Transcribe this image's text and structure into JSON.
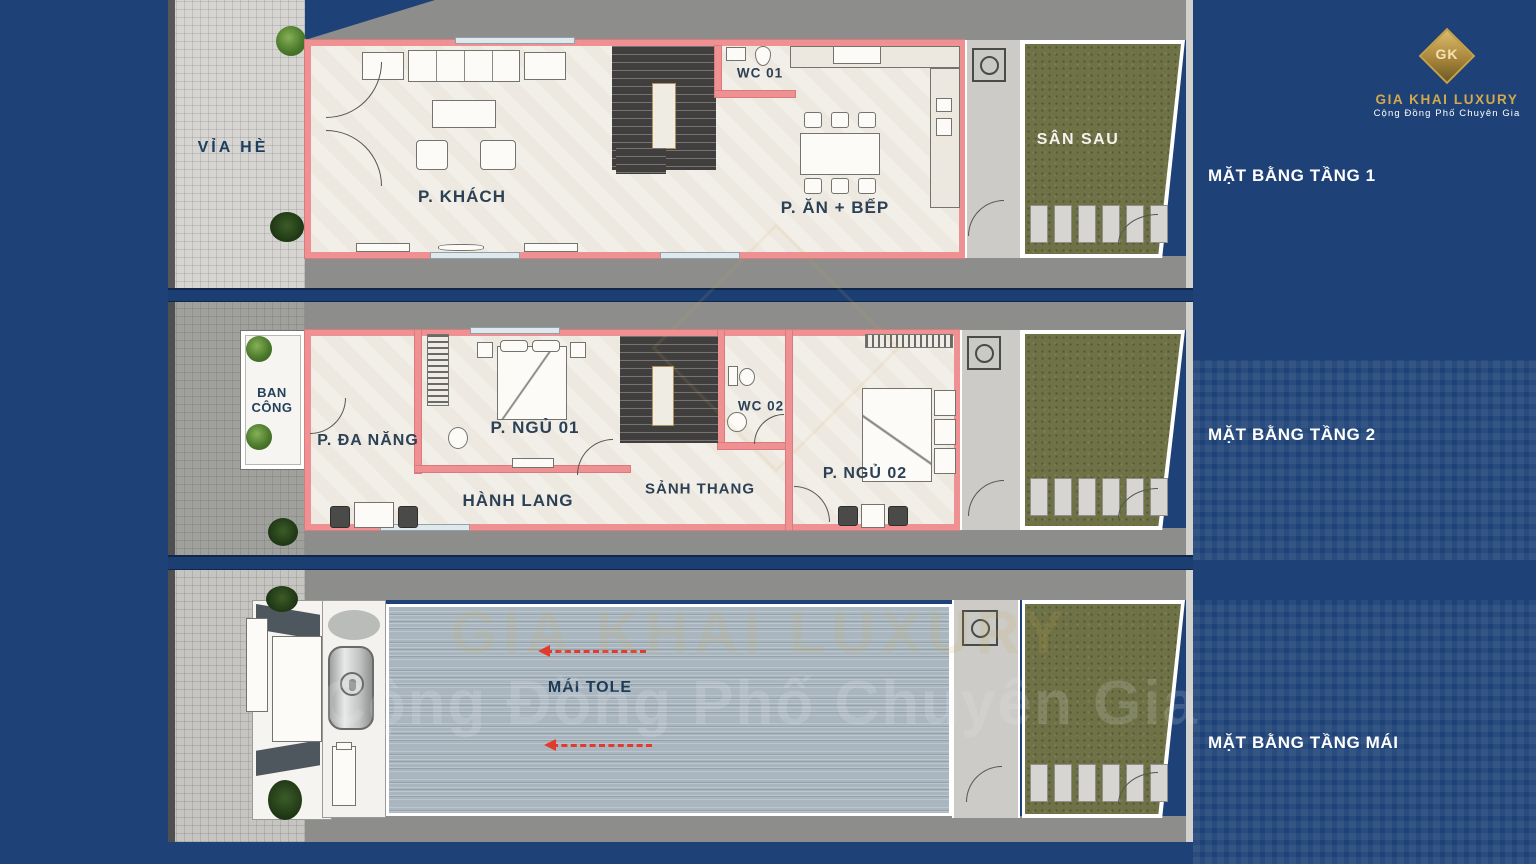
{
  "poster": {
    "background": "#1e4277"
  },
  "logo": {
    "monogram": "GK",
    "brand": "GIA KHAI LUXURY",
    "tagline": "Cộng Đồng Phố Chuyên Gia"
  },
  "floor_labels": {
    "floor1": "MẶT BẰNG TẦNG 1",
    "floor2": "MẶT BẰNG TẦNG 2",
    "roof": "MẶT BẰNG TẦNG MÁI"
  },
  "floor1": {
    "sidewalk": "VỈA HÈ",
    "living_room": "P. KHÁCH",
    "wc": "WC 01",
    "dining_kitchen": "P. ĂN + BẾP",
    "backyard": "SÂN SAU"
  },
  "floor2": {
    "balcony": "BAN CÔNG",
    "multipurpose_room": "P. ĐA NĂNG",
    "bedroom1": "P. NGỦ 01",
    "wc": "WC 02",
    "stair_hall": "SẢNH THANG",
    "bedroom2": "P. NGỦ 02",
    "hallway": "HÀNH LANG"
  },
  "roof_floor": {
    "roof": "MÁI TOLE"
  },
  "colors": {
    "background": "#1e4277",
    "wall_pink": "#ef9093",
    "gold": "#cfa64a",
    "grass_green": "#6e7246",
    "roof_gray_blue": "#aab7bf",
    "arrow_red": "#e23b2e",
    "label_white": "#ffffff",
    "room_text": "#2c4156"
  }
}
